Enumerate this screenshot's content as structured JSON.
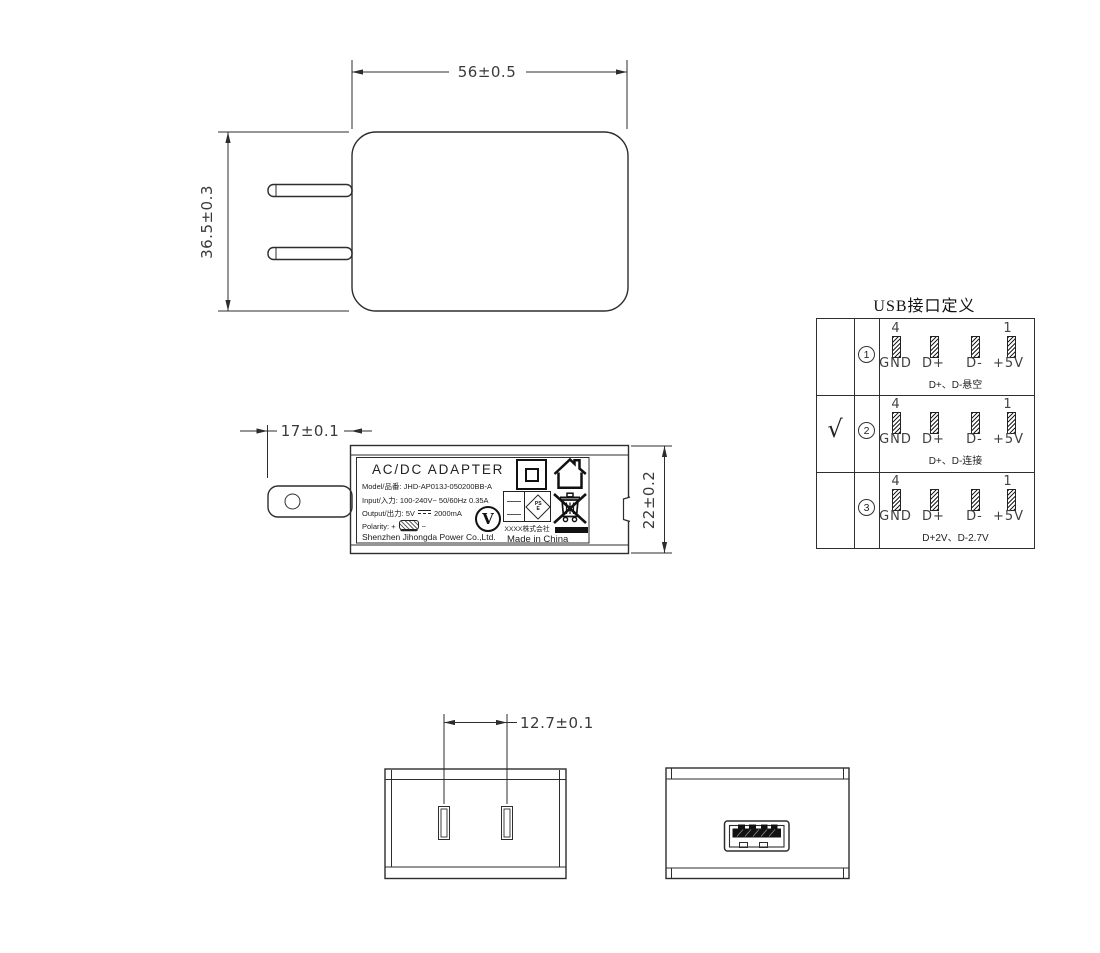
{
  "dims": {
    "front_width": "56±0.5",
    "front_height": "36.5±0.3",
    "prong_length": "17±0.1",
    "body_depth": "22±0.2",
    "pin_spacing": "12.7±0.1"
  },
  "label": {
    "title": "AC/DC ADAPTER",
    "model": "Model/品番: JHD-AP013J-050200BB-A",
    "input": "Input/入力: 100-240V~  50/60Hz  0.35A",
    "output_prefix": "Output/出力: 5V",
    "output_suffix": "2000mA",
    "polarity_label": "Polarity:",
    "polarity_plus": "+",
    "polarity_minus": "−",
    "company": "Shenzhen Jihongda Power Co.,Ltd.",
    "efficiency_mark": "V",
    "pse_ps": "PS",
    "pse_e": "E",
    "maker": "XXXX株式会社",
    "made_in": "Made in China"
  },
  "usb_table": {
    "title": "USB接口定义",
    "pin_top_left": "4",
    "pin_top_right": "1",
    "pin_labels": [
      "GND",
      "D+",
      "D-",
      "+5V"
    ],
    "rows": [
      {
        "check": "",
        "num": "1",
        "caption": "D+、D-悬空"
      },
      {
        "check": "√",
        "num": "2",
        "caption": "D+、D-连接"
      },
      {
        "check": "",
        "num": "3",
        "caption": "D+2V、D-2.7V"
      }
    ]
  }
}
